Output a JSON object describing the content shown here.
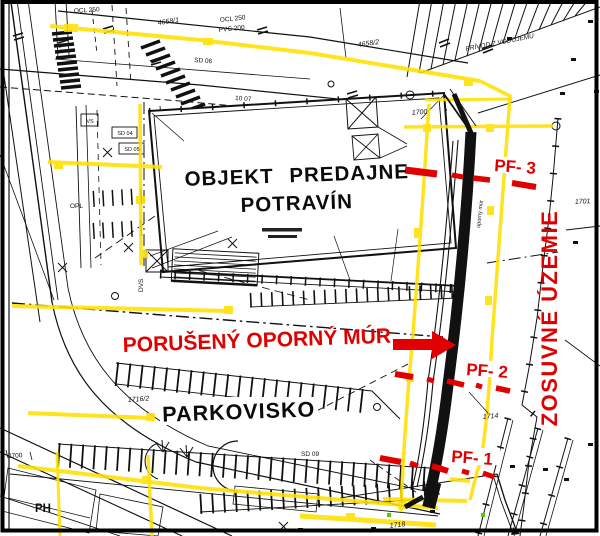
{
  "colors": {
    "highlight_yellow": "#FFE000",
    "alert_red": "#E00000",
    "ink_black": "#111111",
    "marker_green": "#55CC00"
  },
  "labels": {
    "building_line1": "OBJEKT PREDAJNE",
    "building_line2": "POTRAVÍN",
    "parking": "PARKOVISKO",
    "damaged_wall": "PORUŠENÝ OPORNÝ MÚR",
    "landslide_area": "ZOSUVNÉ ÚZEMIE",
    "probe_1": "PF- 1",
    "probe_2": "PF- 2",
    "probe_3": "PF- 3",
    "hydrant": "PH",
    "wall_note": "oporný múr"
  },
  "parcels": {
    "p4658_1": "4658/1",
    "p4658_2": "4658/2",
    "p1700": "1700",
    "p1701": "1701",
    "p1714": "1714",
    "p1716_2": "1716/2",
    "p1718": "1718",
    "p2700": "2700"
  },
  "utilities": {
    "ocl_top": "OCL 250",
    "ocl": "OCL 250",
    "pvc": "PVC 200",
    "privod": "PRÍVOD Z VODOJEMU",
    "sd04": "SD 04",
    "sd05": "SD 05",
    "sd06": "SD 06",
    "sd09": "SD 09",
    "vs": "VS",
    "opl": "OPL",
    "dvs": "DVS",
    "st1007": "10 07"
  }
}
